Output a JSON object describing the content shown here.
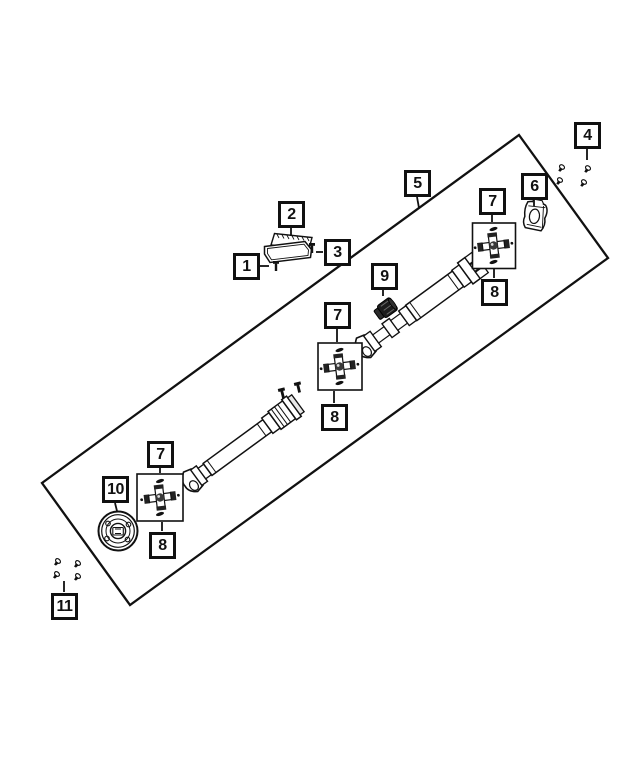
{
  "diagram": {
    "kind": "exploded-parts-diagram",
    "subject": "drive-shaft-assembly",
    "colors": {
      "background": "#ffffff",
      "line": "#111111"
    },
    "callouts": [
      {
        "id": "1",
        "label": "1",
        "x": 233,
        "y": 253
      },
      {
        "id": "2",
        "label": "2",
        "x": 278,
        "y": 201
      },
      {
        "id": "3",
        "label": "3",
        "x": 324,
        "y": 239
      },
      {
        "id": "4",
        "label": "4",
        "x": 574,
        "y": 122
      },
      {
        "id": "5",
        "label": "5",
        "x": 404,
        "y": 170
      },
      {
        "id": "6",
        "label": "6",
        "x": 521,
        "y": 173
      },
      {
        "id": "7a",
        "label": "7",
        "x": 479,
        "y": 188
      },
      {
        "id": "8a",
        "label": "8",
        "x": 481,
        "y": 279
      },
      {
        "id": "7b",
        "label": "7",
        "x": 324,
        "y": 302
      },
      {
        "id": "8b",
        "label": "8",
        "x": 321,
        "y": 404
      },
      {
        "id": "7c",
        "label": "7",
        "x": 147,
        "y": 441
      },
      {
        "id": "8c",
        "label": "8",
        "x": 149,
        "y": 532
      },
      {
        "id": "9",
        "label": "9",
        "x": 371,
        "y": 263
      },
      {
        "id": "10",
        "label": "10",
        "x": 102,
        "y": 476
      },
      {
        "id": "11",
        "label": "11",
        "x": 51,
        "y": 593
      }
    ],
    "part_icons": [
      {
        "callout": "1",
        "icon": "bolt-icon"
      },
      {
        "callout": "2",
        "icon": "support-bracket-icon"
      },
      {
        "callout": "3",
        "icon": "bolt-icon"
      },
      {
        "callout": "4",
        "icon": "screw-set-icon",
        "count": 4
      },
      {
        "callout": "5",
        "icon": "drive-shaft-assembly-icon"
      },
      {
        "callout": "6",
        "icon": "end-yoke-icon"
      },
      {
        "callout": "7",
        "icon": "u-joint-cross-icon"
      },
      {
        "callout": "8",
        "icon": "u-joint-cross-icon"
      },
      {
        "callout": "9",
        "icon": "boot-damper-icon"
      },
      {
        "callout": "10",
        "icon": "companion-flange-icon"
      },
      {
        "callout": "11",
        "icon": "bolt-set-icon",
        "count": 4
      }
    ]
  }
}
